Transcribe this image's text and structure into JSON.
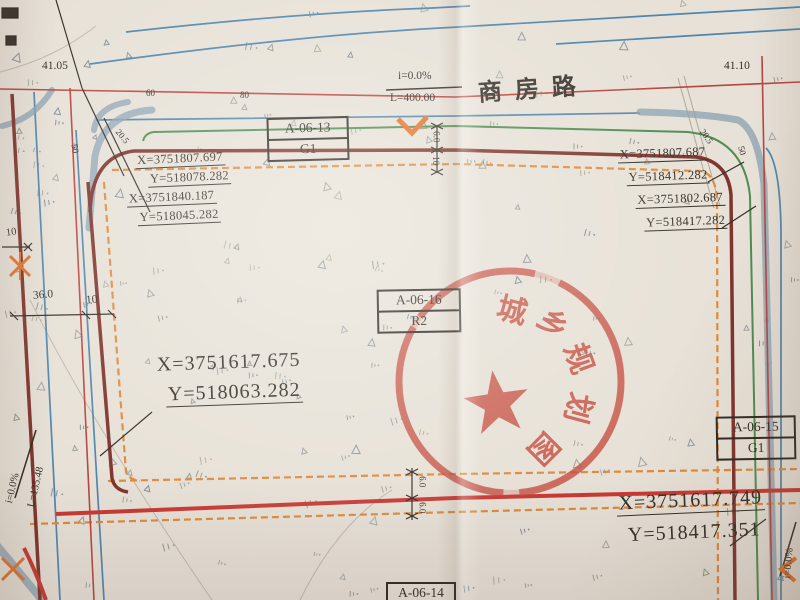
{
  "palette": {
    "paper": "#e7e1d7",
    "planning_red_line": "#c93832",
    "boundary_dark_red": "#7e332b",
    "setback_orange": "#dd8a3c",
    "green_line": "#4e8c52",
    "blue_line": "#4f86ad",
    "curb_grey_blue": "#8ca3b4",
    "stamp_red": "#c64a3c",
    "ink_black": "#332d27"
  },
  "roads": {
    "shangfang": {
      "name": "商房路",
      "slope": "i=0.0%",
      "length": "L=400.00"
    },
    "west_road": {
      "slope": "i=0.0%",
      "length": "L=135.48"
    },
    "east_road": {
      "slope": "i=0.0%"
    }
  },
  "spot_elevations": {
    "left": "41.05",
    "right": "41.10"
  },
  "parcels": {
    "a0613": {
      "code": "A-06-13",
      "use": "G1"
    },
    "a0616": {
      "code": "A-06-16",
      "use": "R2"
    },
    "a0615": {
      "code": "A-06-15",
      "use": "G1"
    },
    "a0614": {
      "code": "A-06-14"
    }
  },
  "coordinates": {
    "nw": {
      "x1": "X=3751807.697",
      "y1": "Y=518078.282",
      "x2": "X=3751840.187",
      "y2": "Y=518045.282"
    },
    "ne": {
      "x1": "X=3751807.687",
      "y1": "Y=518412.282",
      "x2": "X=3751802.687",
      "y2": "Y=518417.282"
    },
    "sw": {
      "x": "X=3751617.675",
      "y": "Y=518063.282"
    },
    "se": {
      "x": "X=3751617.749",
      "y": "Y=518417.351"
    }
  },
  "dimensions": {
    "chainage_60": "60",
    "chainage_80": "80",
    "radius_left_a": "20.5",
    "radius_left_b": "50",
    "radius_right_a": "20.5",
    "radius_right_b": "50",
    "west_width_outer": "10",
    "west_width_main": "36.0",
    "west_width_inner": "10",
    "north_offset_upper": "6.0",
    "north_offset_lower": "10",
    "south_offset_upper": "6.0",
    "south_offset_lower": "6.0"
  },
  "stamp": {
    "chars": [
      "城",
      "乡",
      "规",
      "划",
      "图"
    ]
  },
  "decor": {
    "veg_count": 150,
    "veg_colors": [
      "#5c6c79",
      "#68765a",
      "#4e6478"
    ]
  }
}
